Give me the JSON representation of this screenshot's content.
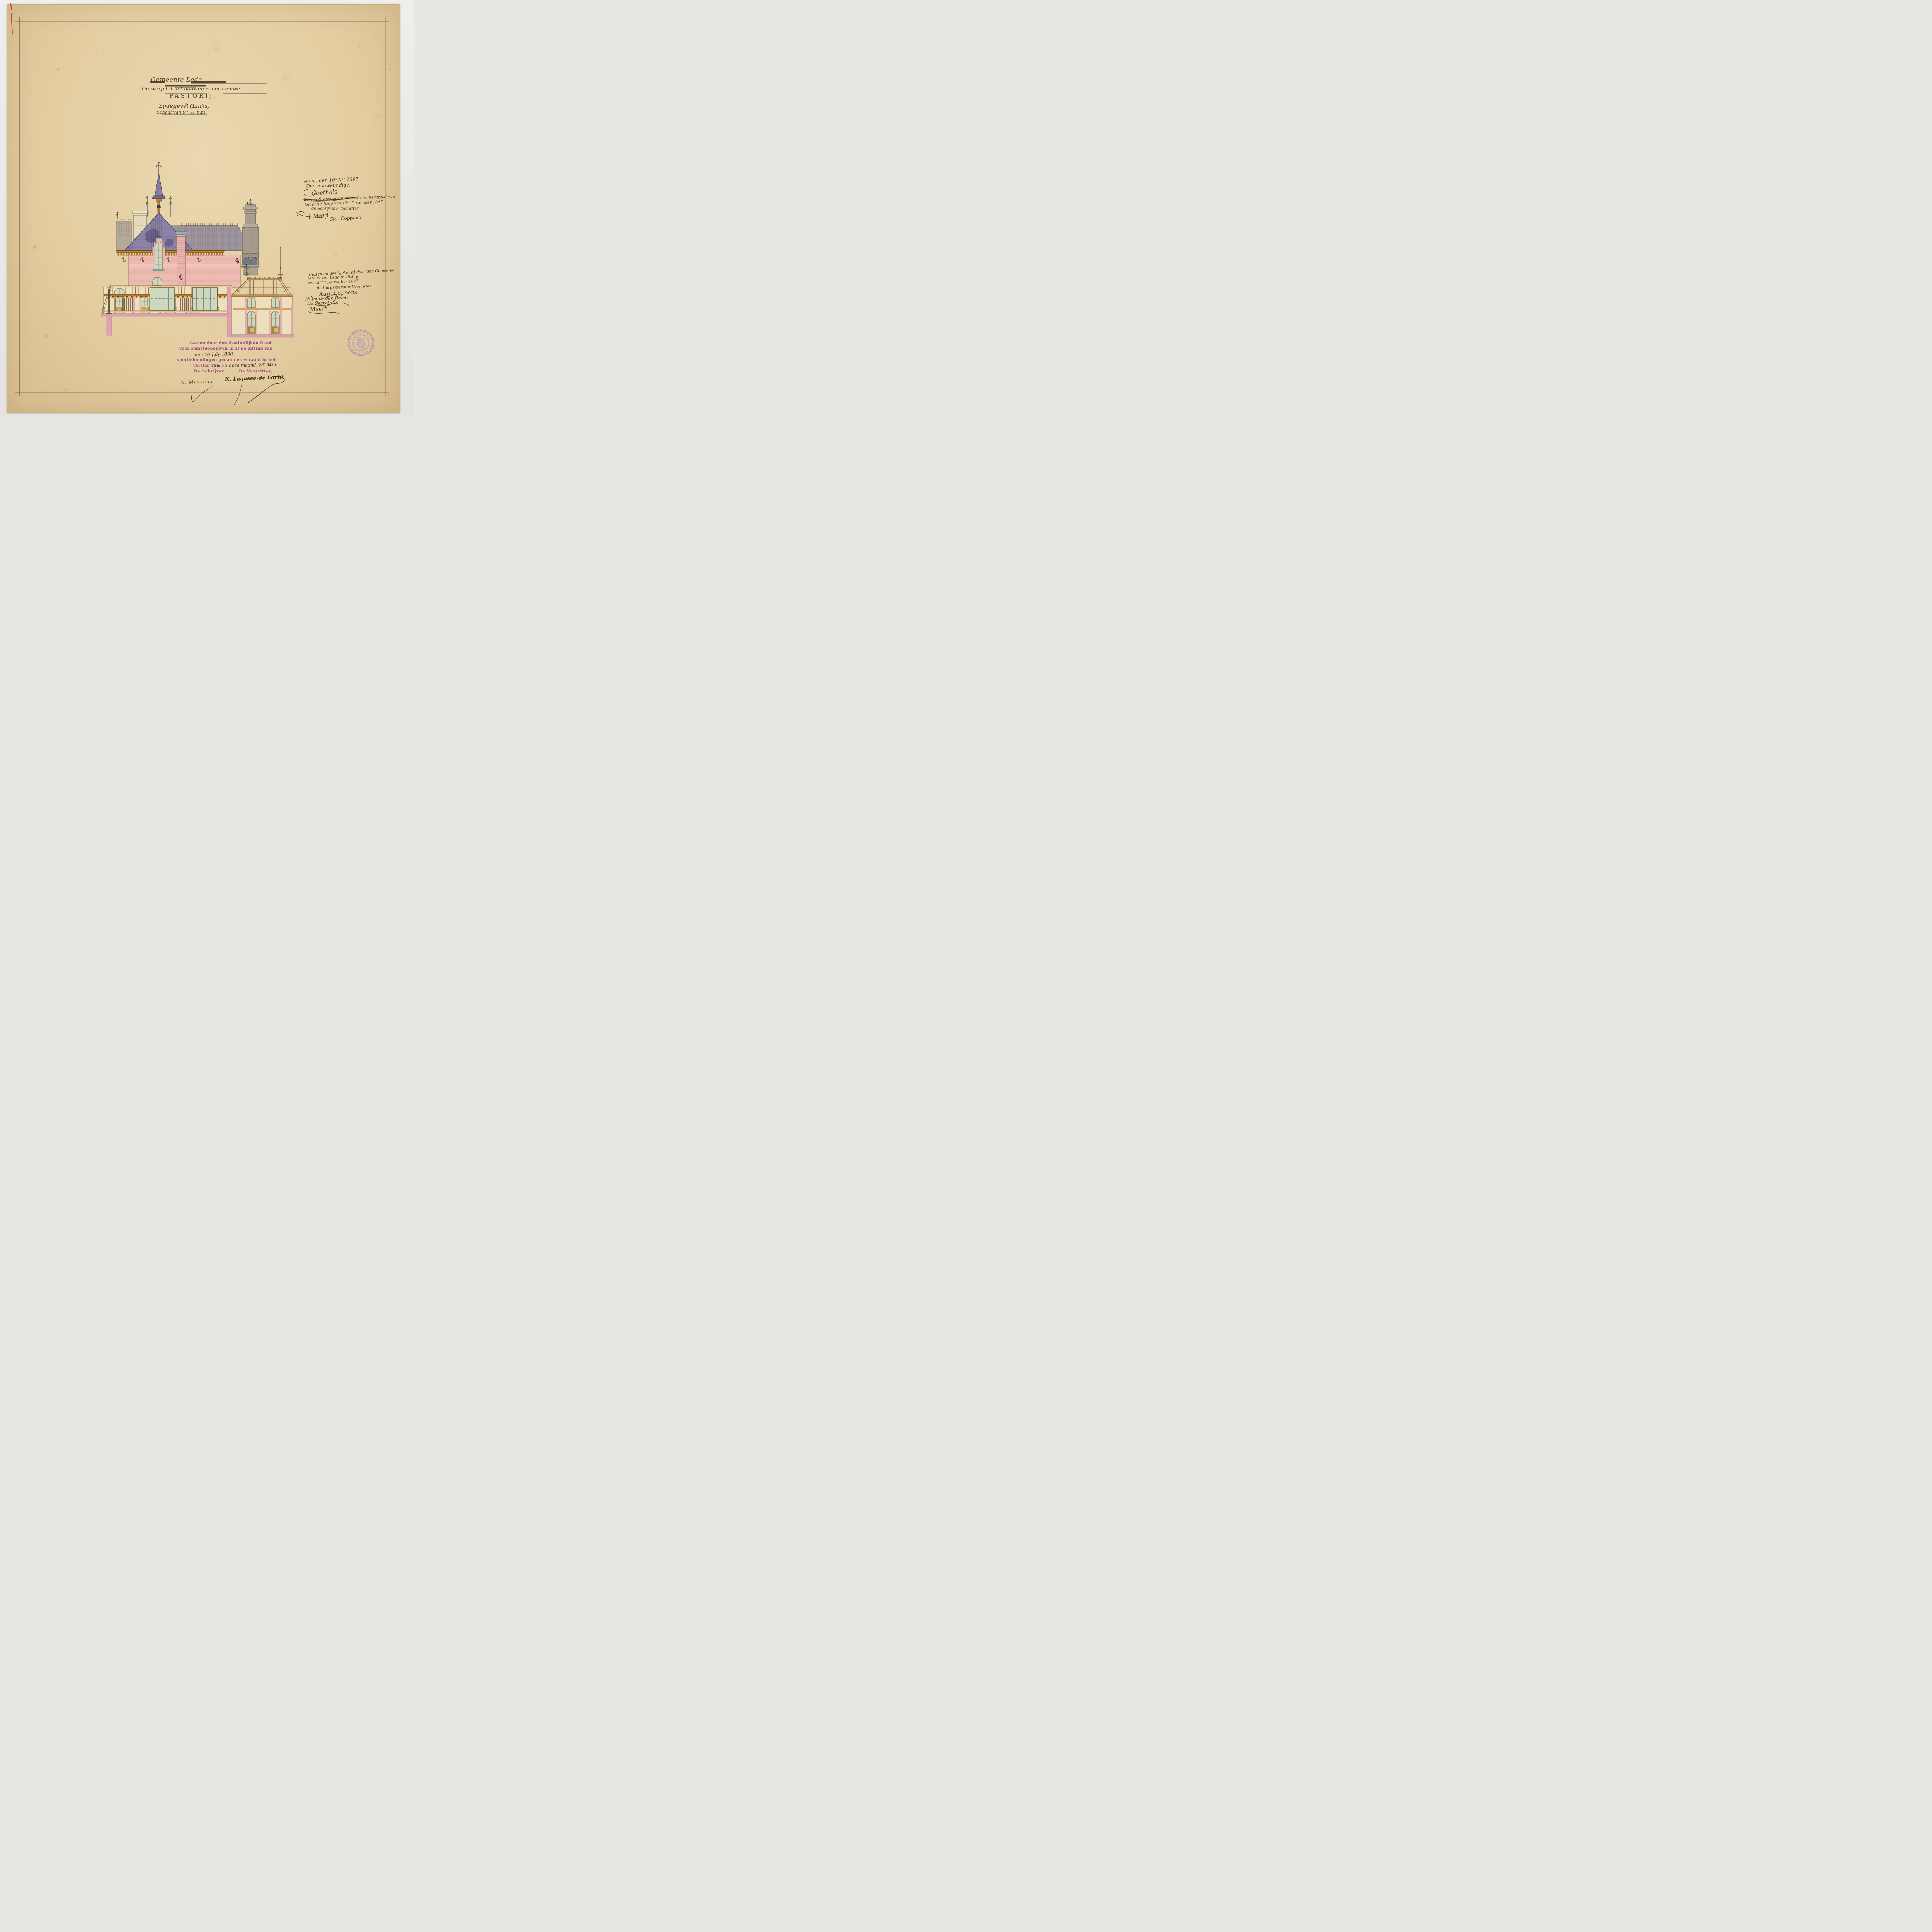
{
  "title_block": {
    "line1": "Gemeente Lede.",
    "line2": "Ontwerp tot het bouwen eener nieuwe",
    "line3": "PASTORIJ.",
    "line4": "Zijdegevel (Links)",
    "line5": "Schaal van 0ᵐ.01 p.m."
  },
  "annotations": {
    "aalst": {
      "line1": "Aalst, den 10ⁿ Xᵇʳ 1897",
      "line2": "Den Bouwkundige,",
      "signature": "Goethals"
    },
    "kerkraad": {
      "line1": "Gezien & goedgekeurd door den Kerkraad van",
      "line2": "Lede in zitting van 17ᵉⁿ December 1897",
      "left_role": "de Schrijver",
      "right_role": "de Voorzitter",
      "left_sig": "J. Meert",
      "right_sig": "Chl. Coppens"
    },
    "gemeenteraad": {
      "line1": "Gezien en goedgekeurd door den Gemeen=",
      "line2": "teraad van Lede in zitting",
      "line3": "van 28ˢᵗᵉⁿ December 1897",
      "role": "de Burgemeester Voorzitter",
      "sig": "Aug. Coppens",
      "line4": "Namens den Raad:",
      "line5": "De Secretaris",
      "sig2": "Meert"
    }
  },
  "royal_council": {
    "line1": "Gezien door den Koninklijken Raad",
    "line2": "voor Kunstgebouwen in zijne zitting van",
    "hand1": "den 16 July 1898.",
    "line3": "voorbehoudingen gedaan en veraald in het",
    "line4": "verslag van",
    "hand2": "den 22 deze maand, Nº 5406.",
    "left_role": "De Schrijver,",
    "right_role": "De Voorzitter,",
    "left_sig": "A. Massaux",
    "right_sig": "K. Lagasse-de Locht"
  },
  "stamp": {
    "text_top": "GEMEENTE-BESTUUR VAN LEDE",
    "text_bottom": "✶ OOST-VLAANDEREN ✶",
    "color": "#9478b8"
  },
  "colors": {
    "paper": "#e3cda1",
    "ink": "#4a3a26",
    "stamp_purple": "#9478b8",
    "text_purple": "#984a86",
    "roof_purple": "#8b82a6",
    "facade_pink": "#ecbcb3",
    "section_pink": "#dc9fae",
    "wall_cream": "#eedfbc",
    "wood_orange": "#c08235",
    "glass_green": "#ccd7bf",
    "cap_blue": "#8fb4bb"
  }
}
